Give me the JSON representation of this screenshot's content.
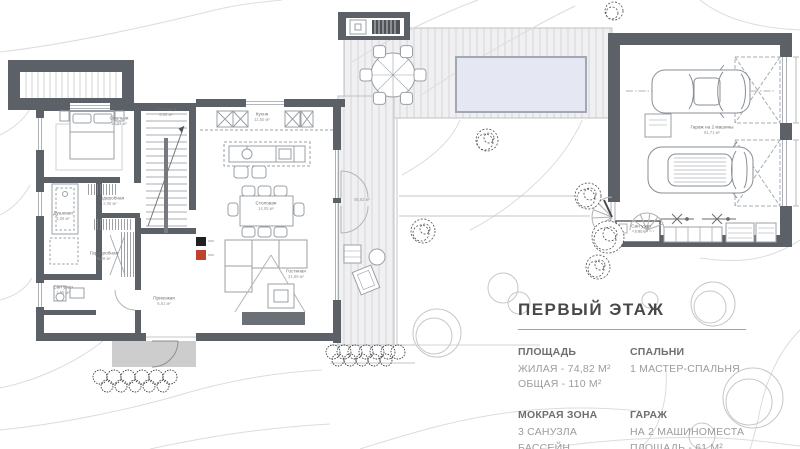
{
  "legend": {
    "title": "ПЕРВЫЙ ЭТАЖ",
    "sections": [
      {
        "heading": "ПЛОЩАДЬ",
        "lines": [
          "ЖИЛАЯ - 74,82 М²",
          "ОБЩАЯ - 110 М²"
        ]
      },
      {
        "heading": "СПАЛЬНИ",
        "lines": [
          "1 МАСТЕР-СПАЛЬНЯ"
        ]
      },
      {
        "heading": "МОКРАЯ ЗОНА",
        "lines": [
          "3 САНУЗЛА",
          "БАССЕЙН"
        ]
      },
      {
        "heading": "ГАРАЖ",
        "lines": [
          "НА 2 МАШИНОМЕСТА",
          "ПЛОЩАДЬ - 61 М²"
        ]
      }
    ]
  },
  "rooms": [
    {
      "name": "Спальня",
      "area": "13,37 м²"
    },
    {
      "name": "Лестница",
      "area": "5,06 м²"
    },
    {
      "name": "Кухня",
      "area": "11,50 м²"
    },
    {
      "name": "Столовая",
      "area": "14,05 м²"
    },
    {
      "name": "Гостиная",
      "area": "21,86 м²"
    },
    {
      "name": "Душевая",
      "area": "4,06 м²"
    },
    {
      "name": "Гардеробная",
      "area": "2,06 м²"
    },
    {
      "name": "Гардеробная",
      "area": "5,08 м²"
    },
    {
      "name": "Сан узел",
      "area": "1,65 м²"
    },
    {
      "name": "Прихожая",
      "area": "5,61 м²"
    },
    {
      "name": "Гараж на 2 машины",
      "area": "61,71 м²"
    },
    {
      "name": "Сан узел",
      "area": "1,61 м²"
    }
  ],
  "deck_label": "56,62 м²",
  "colors": {
    "wall": "#5b6167",
    "deck": "#f0eff1",
    "deck_stripe": "#e3e2e5",
    "pool": "#e5e7f2",
    "pool_border": "#a2a8b2",
    "porch": "#cdcdcd",
    "media_wall": "#6b7077",
    "marker_red": "#c2402e",
    "marker_black": "#202020",
    "contour": "#dcdcdc",
    "furniture_line": "#9aa0a6"
  }
}
